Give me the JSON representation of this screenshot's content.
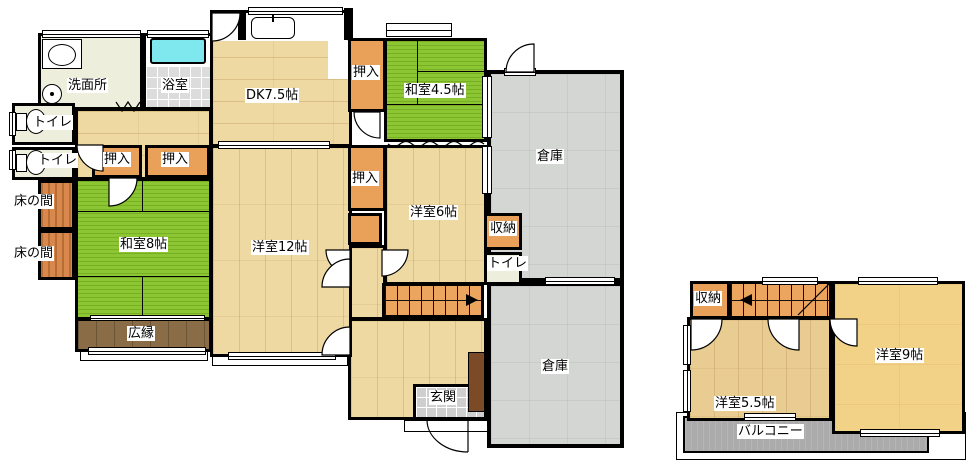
{
  "floor1": {
    "rooms": {
      "washroom": "洗面所",
      "bath": "浴室",
      "dk": "DK7.5帖",
      "closet": "押入",
      "washitsu45": "和室4.5帖",
      "warehouse": "倉庫",
      "toilet": "トイレ",
      "tokonoma": "床の間",
      "washitsu8": "和室8帖",
      "yoshitsu12": "洋室12帖",
      "yoshitsu6": "洋室6帖",
      "storage": "収納",
      "veranda": "広縁",
      "entrance": "玄関"
    }
  },
  "floor2": {
    "rooms": {
      "storage": "収納",
      "yoshitsu55": "洋室5.5帖",
      "yoshitsu9": "洋室9帖",
      "balcony": "バルコニー"
    }
  },
  "colors": {
    "tatami": "#8CC632",
    "wood": "#EFD9A2",
    "woodlight": "#E9CF9B",
    "wood55": "#E8CC92",
    "yellow9": "#F2D287",
    "closet": "#E9A159",
    "tokonoma": "#D8884C",
    "storage": "#D3D6D2",
    "veranda": "#8A6D46",
    "cream": "#EDEEDC",
    "tile": "#DCDCDC",
    "genkan": "#CFCFCF",
    "balcony": "#ABABAB",
    "stair": "#ECA55E",
    "cabinet": "#7B4A26",
    "tub": "#7EE8EE",
    "wall": "#000000"
  }
}
